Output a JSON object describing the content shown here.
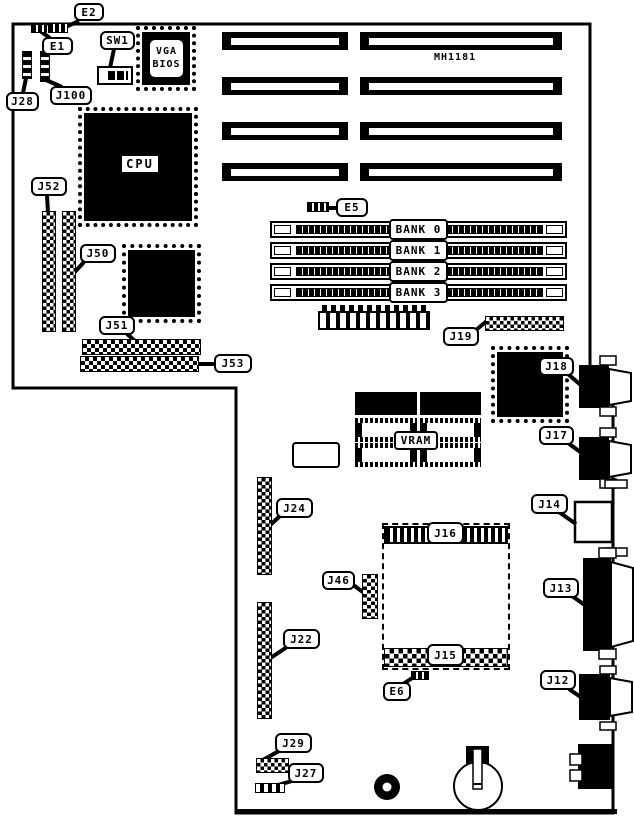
{
  "board": {
    "model": "MH1181"
  },
  "chips": {
    "cpu": "CPU",
    "vram": "VRAM",
    "vga_line1": "VGA",
    "vga_line2": "BIOS"
  },
  "banks": [
    "BANK 0",
    "BANK 1",
    "BANK 2",
    "BANK 3"
  ],
  "callouts": {
    "e2": "E2",
    "e1": "E1",
    "sw1": "SW1",
    "j28": "J28",
    "j100": "J100",
    "j52": "J52",
    "j50": "J50",
    "j51": "J51",
    "j53": "J53",
    "e5": "E5",
    "j19": "J19",
    "j18": "J18",
    "j17": "J17",
    "j14": "J14",
    "j13": "J13",
    "j12": "J12",
    "j24": "J24",
    "j46": "J46",
    "j22": "J22",
    "j16": "J16",
    "j15": "J15",
    "e6": "E6",
    "j29": "J29",
    "j27": "J27"
  },
  "colors": {
    "ink": "#000000",
    "paper": "#ffffff"
  }
}
